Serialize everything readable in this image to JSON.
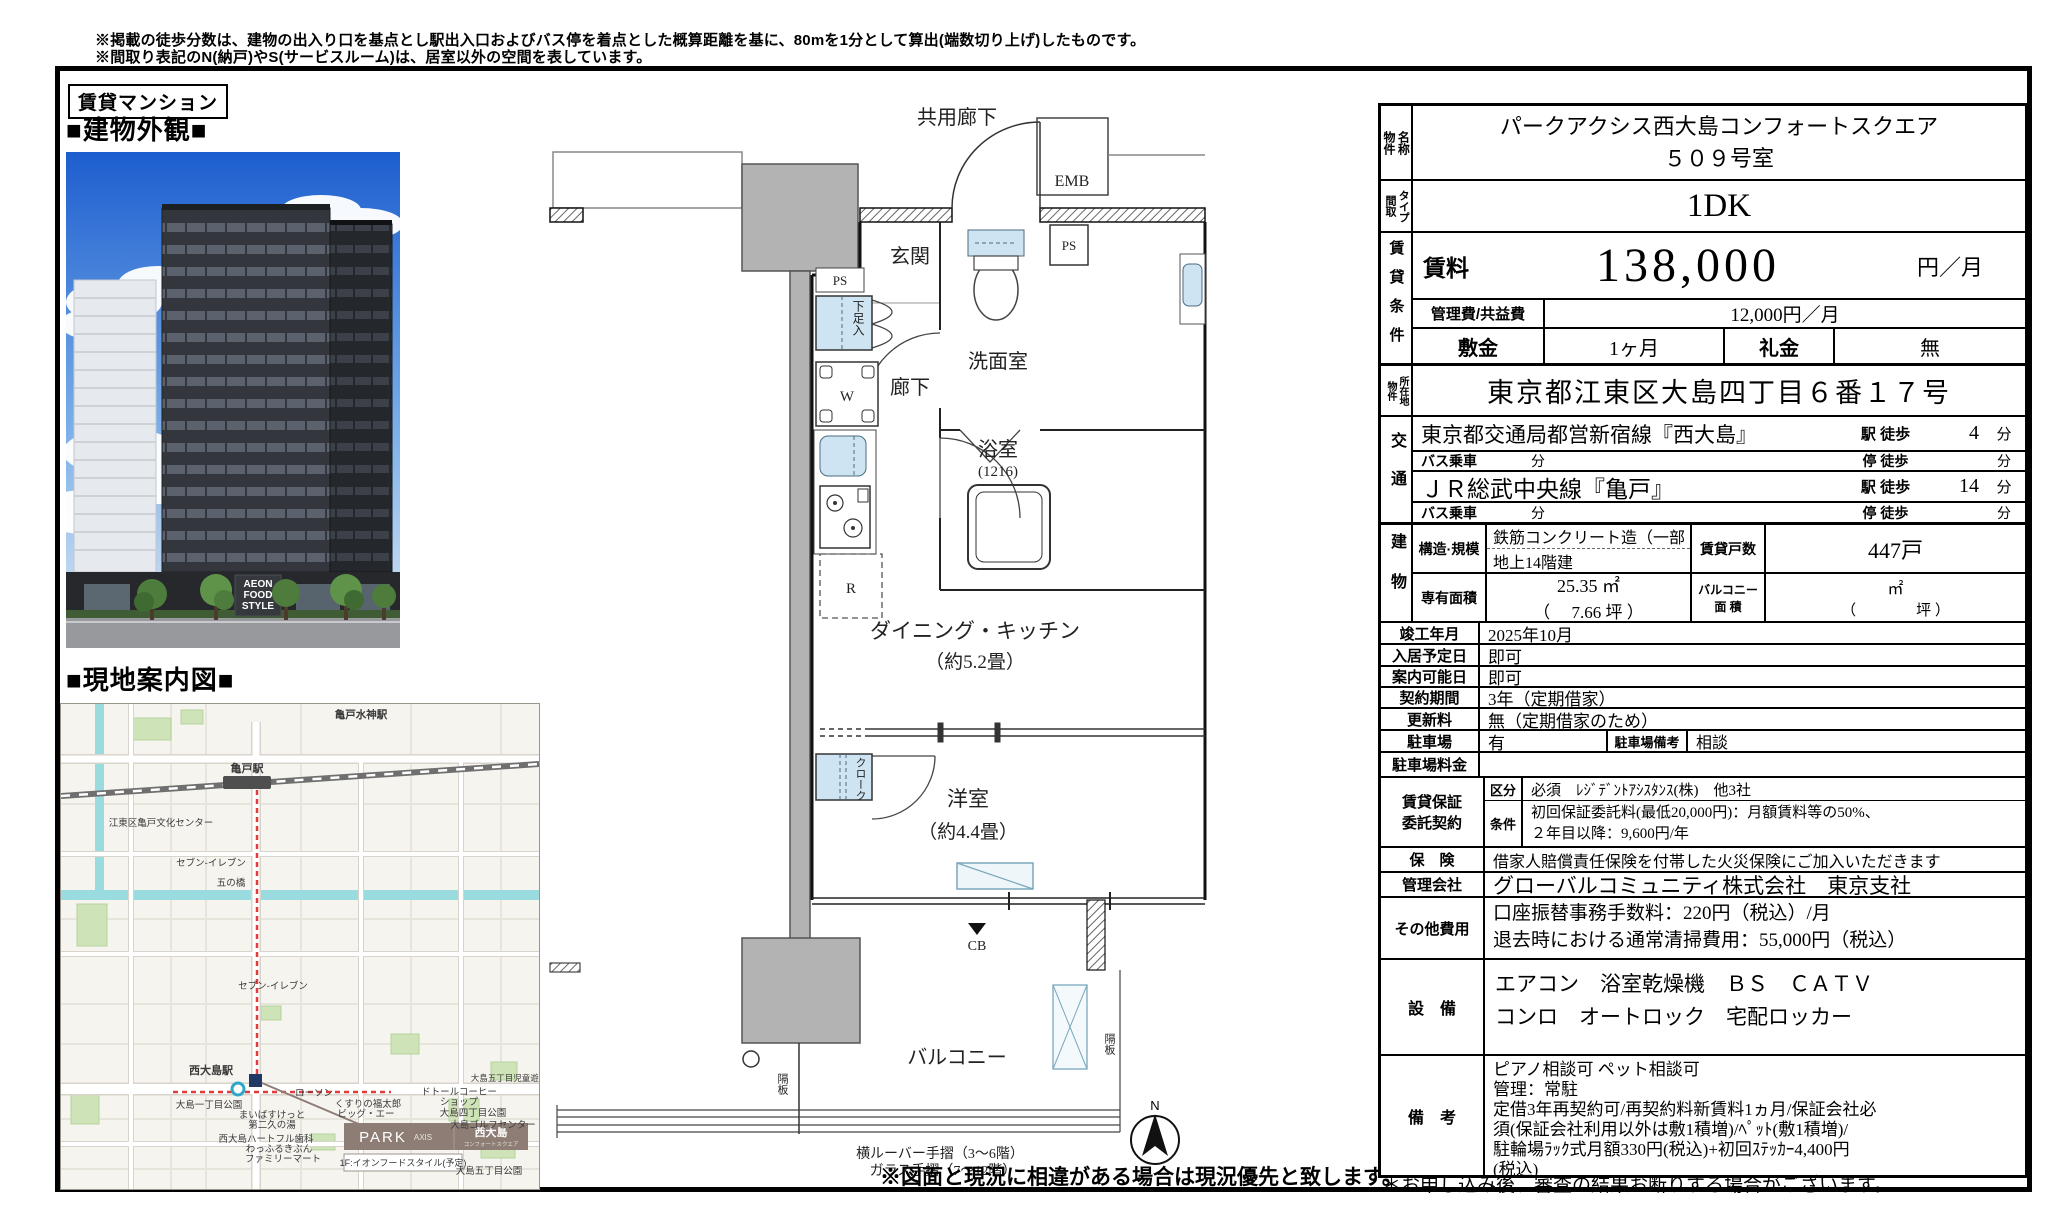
{
  "disclaimer": {
    "line1": "※掲載の徒歩分数は、建物の出入り口を基点とし駅出入口およびバス停を着点とした概算距離を基に、80mを1分として算出(端数切り上げ)したものです。",
    "line2": "※間取り表記のN(納戸)やS(サービスルーム)は、居室以外の空間を表しています。",
    "line3": "詳細については(https://www.mitsui-chintai.co.jp/service/annotation/layout.html)をご確認ください。"
  },
  "left_panel": {
    "category_tag": "賃貸マンション",
    "exterior_heading": "■建物外観■",
    "map_heading": "■現地案内図■",
    "photo_sign_line1": "AEON",
    "photo_sign_line2": "FOOD",
    "photo_sign_line3": "STYLE",
    "map": {
      "labels": [
        {
          "t": "亀戸水神駅"
        },
        {
          "t": "亀戸駅"
        },
        {
          "t": "江東区亀戸文化センター"
        },
        {
          "t": "五の橋"
        },
        {
          "t": "セブン-イレブン"
        },
        {
          "t": "セブン-イレブン"
        },
        {
          "t": "西大島駅"
        },
        {
          "t": "ローソン"
        },
        {
          "t": "大島一丁目公園"
        },
        {
          "t": "まいばすけっと"
        },
        {
          "t": "第二久の湯"
        },
        {
          "t": "西大島ハートフル歯科"
        },
        {
          "t": "わっふるきぶん"
        },
        {
          "t": "ファミリーマート"
        },
        {
          "t": "くすりの福太郎"
        },
        {
          "t": "ビッグ・エー"
        },
        {
          "t": "ドトールコーヒー"
        },
        {
          "t": "ショップ"
        },
        {
          "t": "大島四丁目公園"
        },
        {
          "t": "大島ゴルフセンター"
        },
        {
          "t": "大島五丁目児童遊園"
        },
        {
          "t": "大島五丁目公園"
        }
      ],
      "park_axis_brand": "PARK",
      "park_axis_brand_sub": "AXIS",
      "park_axis_name": "西大島",
      "park_axis_name_sub": "コンフォートスクエア",
      "park_axis_note": "1F:イオンフードスタイル(予定)"
    }
  },
  "floorplan": {
    "common_corridor": "共用廊下",
    "emb": "EMB",
    "ps_top": "PS",
    "ps_left": "PS",
    "entrance": "玄関",
    "shoe_box": "下足入",
    "washer": "W",
    "corridor": "廊下",
    "washroom": "洗面室",
    "bath": "浴室",
    "bath_size": "(1216)",
    "fridge": "R",
    "dk": "ダイニング・キッチン",
    "dk_size": "（約5.2畳）",
    "closet": "クローク",
    "bedroom": "洋室",
    "bedroom_size": "（約4.4畳）",
    "cb": "CB",
    "balcony": "バルコニー",
    "partition_left": "隔板",
    "partition_right": "隔板",
    "north": "N",
    "rail_note1": "横ルーバー手摺（3～6階）",
    "rail_note2": "ガラス手摺（7～12階）",
    "plan_note": "※図面と現況に相違がある場合は現況優先と致します。"
  },
  "table": {
    "property_name_label": "物件\n名称",
    "property_name": "パークアクシス西大島コンフォートスクエア\n５０９号室",
    "layout_label": "間取\nタイプ",
    "layout": "1DK",
    "rent_section_label": "賃貸条件",
    "rent_label": "賃料",
    "rent_value": "138,000",
    "rent_unit": "円／月",
    "fee_label": "管理費/共益費",
    "fee_value": "12,000円／月",
    "deposit_label": "敷金",
    "deposit_value": "1ヶ月",
    "key_label": "礼金",
    "key_value": "無",
    "address_label": "物件\n所在地",
    "address": "東京都江東区大島四丁目６番１７号",
    "access_label": "交通",
    "access1_line": "東京都交通局都営新宿線『西大島』",
    "access1_mode": "駅 徒歩",
    "access1_min": "4",
    "access1_unit": "分",
    "access2_label": "バス乗車",
    "access2_mid": "分",
    "access2_mode": "停 徒歩",
    "access2_min": "",
    "access2_unit": "分",
    "access3_line": "ＪＲ総武中央線『亀戸』",
    "access3_mode": "駅 徒歩",
    "access3_min": "14",
    "access3_unit": "分",
    "access4_label": "バス乗車",
    "access4_mid": "分",
    "access4_mode": "停 徒歩",
    "access4_min": "",
    "access4_unit": "分",
    "building_label": "建物",
    "structure_label": "構造·規模",
    "structure_line1": "鉄筋コンクリート造（一部",
    "structure_line2": "地上14階建",
    "units_label": "賃貸戸数",
    "units_value": "447戸",
    "area_label": "専有面積",
    "area_value": "25.35 ㎡",
    "area_tsubo": "（　 7.66 坪 ）",
    "balcony_label": "バルコニー\n面 積",
    "balcony_value": "㎡",
    "balcony_tsubo": "（　　　　坪 ）",
    "completion_label": "竣工年月",
    "completion": "2025年10月",
    "movein_label": "入居予定日",
    "movein": "即可",
    "viewing_label": "案内可能日",
    "viewing": "即可",
    "contract_label": "契約期間",
    "contract": "3年（定期借家）",
    "renewal_label": "更新料",
    "renewal": "無（定期借家のため）",
    "parking_label": "駐車場",
    "parking": "有",
    "parking_note_label": "駐車場備考",
    "parking_note": "相談",
    "parking_fee_label": "駐車場料金",
    "parking_fee": "",
    "guarantee_label": "賃貸保証\n委託契約",
    "guarantee_kubun_label": "区分",
    "guarantee_kubun": "必須　ﾚｼﾞﾃﾞﾝﾄｱｼｽﾀﾝｽ(株)　他3社",
    "guarantee_cond_label": "条件",
    "guarantee_cond": "初回保証委託料(最低20,000円)：月額賃料等の50%、\n２年目以降：9,600円/年",
    "insurance_label": "保　険",
    "insurance": "借家人賠償責任保険を付帯した火災保険にご加入いただきます",
    "management_label": "管理会社",
    "management": "グローバルコミュニティ株式会社　東京支社",
    "other_label": "その他費用",
    "other": "口座振替事務手数料：220円（税込）/月\n退去時における通常清掃費用：55,000円（税込）",
    "equipment_label": "設　備",
    "equipment": "エアコン　浴室乾燥機　ＢＳ　ＣＡＴＶ\nコンロ　オートロック　宅配ロッカー",
    "remarks_label": "備　考",
    "remarks": "ピアノ相談可 ペット相談可\n管理：常駐\n定借3年再契約可/再契約料新賃料1ヵ月/保証会社必\n須(保証会社利用以外は敷1積増)/ﾍﾟｯﾄ(敷1積増)/\n駐輪場ﾗｯｸ式月額330円(税込)+初回ｽﾃｯｶｰ4,400円\n(税込)",
    "apply_note": "＊お申し込み後、審査の結果お断りする場合がございます。"
  }
}
